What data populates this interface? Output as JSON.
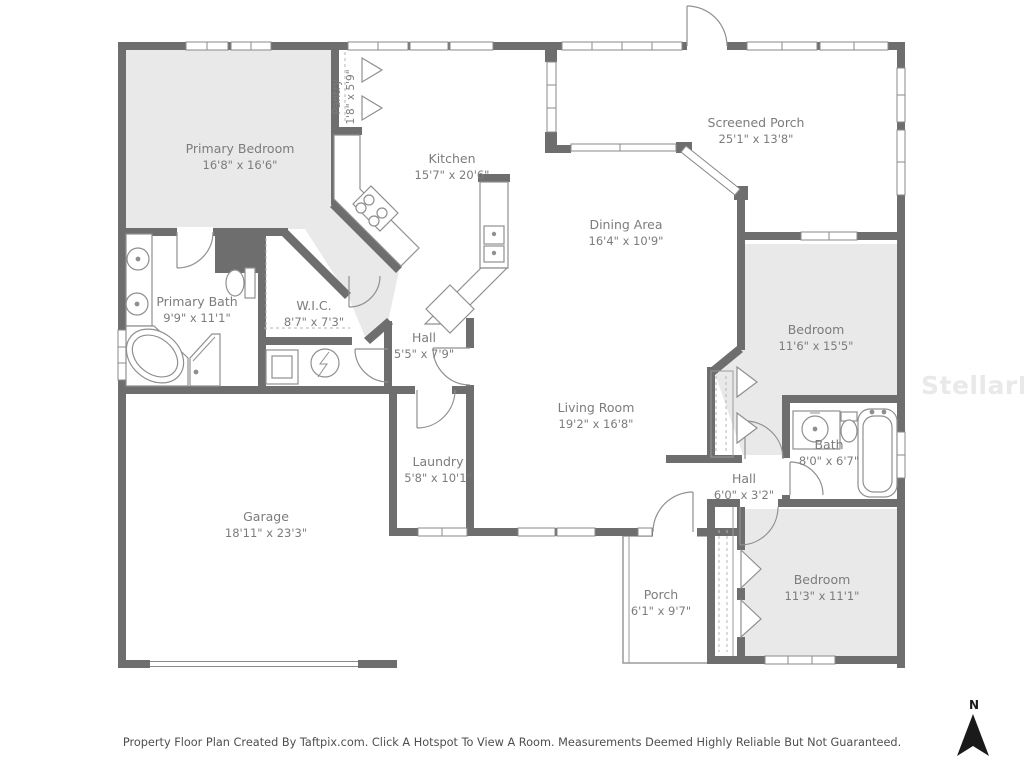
{
  "floorplan": {
    "rooms": [
      {
        "name": "Primary Bedroom",
        "dims": "16'8\" x 16'6\""
      },
      {
        "name": "Pantry",
        "dims": "1'8\" x 5'9\""
      },
      {
        "name": "Kitchen",
        "dims": "15'7\" x 20'6\""
      },
      {
        "name": "Screened Porch",
        "dims": "25'1\" x 13'8\""
      },
      {
        "name": "Dining Area",
        "dims": "16'4\" x 10'9\""
      },
      {
        "name": "Primary Bath",
        "dims": "9'9\" x 11'1\""
      },
      {
        "name": "W.I.C.",
        "dims": "8'7\" x 7'3\""
      },
      {
        "name": "Hall",
        "dims": "5'5\" x 7'9\""
      },
      {
        "name": "Bedroom",
        "dims": "11'6\" x 15'5\""
      },
      {
        "name": "Living Room",
        "dims": "19'2\" x 16'8\""
      },
      {
        "name": "Bath",
        "dims": "8'0\" x 6'7\""
      },
      {
        "name": "Hall",
        "dims": "6'0\" x 3'2\""
      },
      {
        "name": "Laundry",
        "dims": "5'8\" x 10'1\""
      },
      {
        "name": "Garage",
        "dims": "18'11\" x 23'3\""
      },
      {
        "name": "Porch",
        "dims": "6'1\" x 9'7\""
      },
      {
        "name": "Bedroom",
        "dims": "11'3\" x 11'1\""
      }
    ],
    "watermark": "StellarMLS",
    "caption": "Property Floor Plan Created By Taftpix.com. Click A Hotspot To View A Room. Measurements Deemed Highly Reliable But Not Guaranteed.",
    "compass_label": "N",
    "colors": {
      "wall": "#6e6e6e",
      "room_fill": "#e9e9e9",
      "line": "#909090",
      "text": "#7c7c7c"
    }
  }
}
